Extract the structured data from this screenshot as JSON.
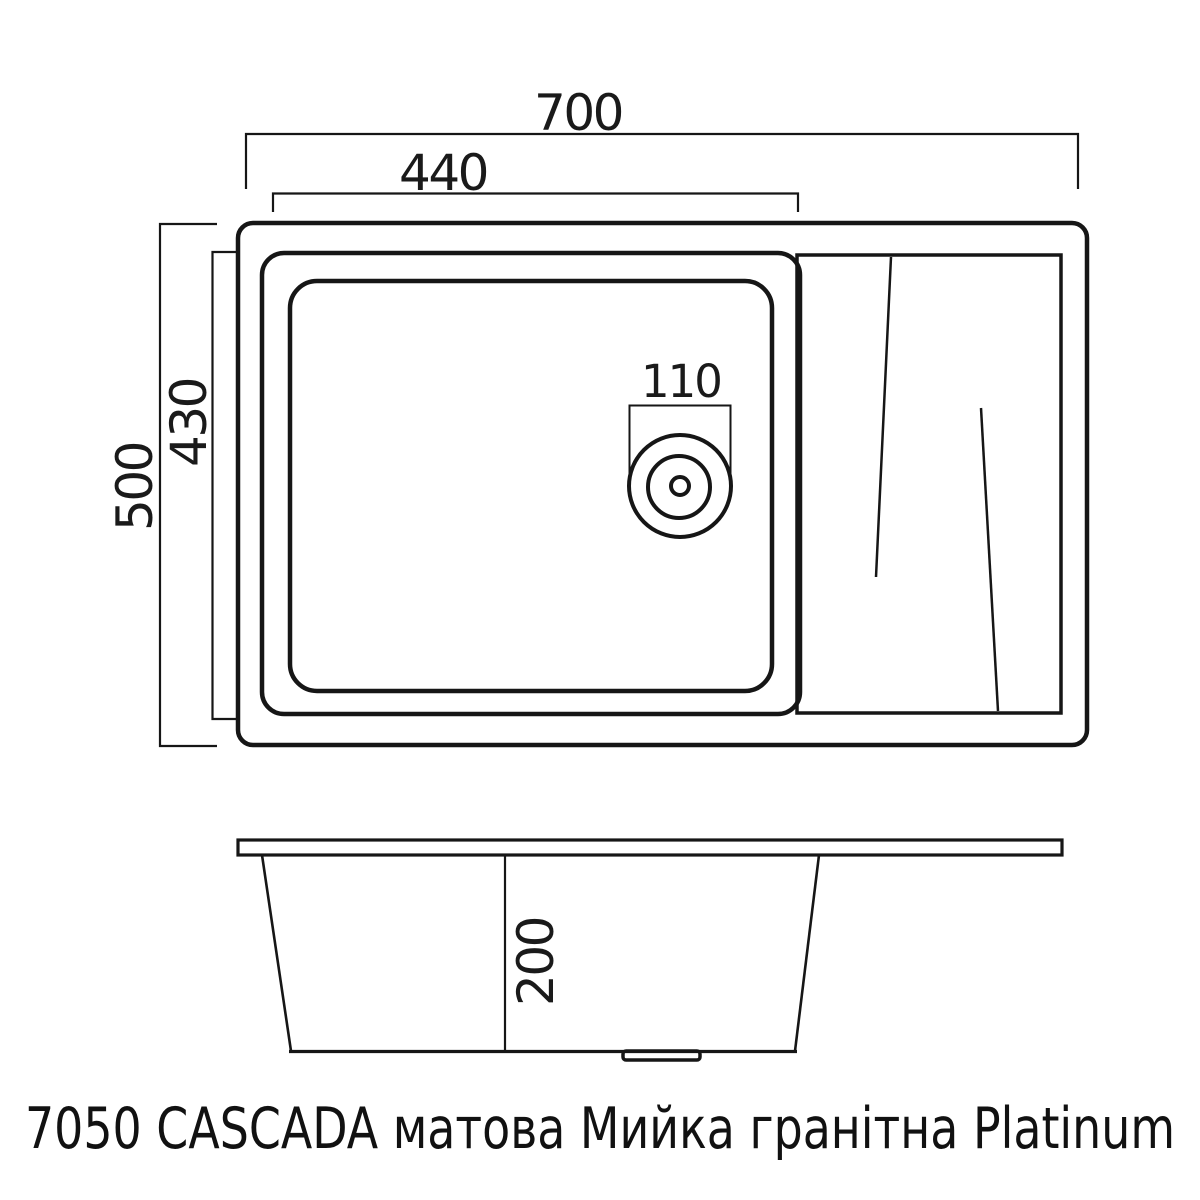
{
  "caption": "7050 CASCADA матова Мийка гранітна Platinum",
  "colors": {
    "background": "#ffffff",
    "line": "#161616",
    "text": "#1a1a1a"
  },
  "top_view": {
    "description": "plan view of granite sink with bowl, drain and drainboard",
    "dims": {
      "overall_width": "700",
      "bowl_cutout_width": "440",
      "overall_depth": "500",
      "bowl_cutout_depth": "430",
      "drain_diameter": "110"
    }
  },
  "section_view": {
    "description": "front section view of sink bowl under countertop rim",
    "dims": {
      "bowl_depth": "200"
    }
  }
}
